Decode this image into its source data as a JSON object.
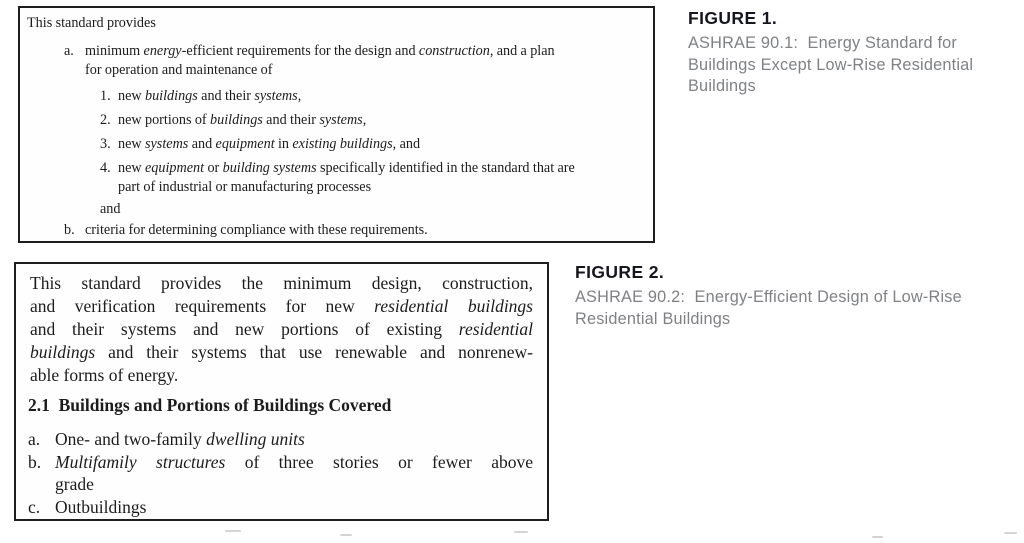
{
  "colors": {
    "page_background": "#ffffff",
    "box_border": "#1e1e1e",
    "scan_text": "#1c1c1c",
    "figure_label": "#16161f",
    "caption_text": "#7f8184"
  },
  "figure1": {
    "label": "FIGURE 1.",
    "caption": "ASHRAE 90.1:  Energy Standard for Buildings Except Low-Rise Residential Buildings"
  },
  "figure2": {
    "label": "FIGURE 2.",
    "caption": "ASHRAE 90.2:  Energy-Efficient Design of Low-Rise Residential Buildings"
  },
  "box1": {
    "intro": "This standard provides",
    "item_a": {
      "marker": "a.",
      "segments": [
        {
          "t": "minimum "
        },
        {
          "t": "energy",
          "i": true
        },
        {
          "t": "-efficient requirements for the design and "
        },
        {
          "t": "construction",
          "i": true
        },
        {
          "t": ", and a plan"
        },
        {
          "br": true
        },
        {
          "t": "for operation and maintenance of"
        }
      ]
    },
    "sub_items": [
      {
        "marker": "1.",
        "segments": [
          {
            "t": "new "
          },
          {
            "t": "buildings",
            "i": true
          },
          {
            "t": " and their "
          },
          {
            "t": "systems",
            "i": true
          },
          {
            "t": ","
          }
        ]
      },
      {
        "marker": "2.",
        "segments": [
          {
            "t": "new portions of "
          },
          {
            "t": "buildings",
            "i": true
          },
          {
            "t": " and their "
          },
          {
            "t": "systems",
            "i": true
          },
          {
            "t": ","
          }
        ]
      },
      {
        "marker": "3.",
        "segments": [
          {
            "t": "new "
          },
          {
            "t": "systems",
            "i": true
          },
          {
            "t": " and "
          },
          {
            "t": "equipment",
            "i": true
          },
          {
            "t": " in "
          },
          {
            "t": "existing buildings",
            "i": true
          },
          {
            "t": ", and"
          }
        ]
      },
      {
        "marker": "4.",
        "segments": [
          {
            "t": "new "
          },
          {
            "t": "equipment",
            "i": true
          },
          {
            "t": " or "
          },
          {
            "t": "building systems",
            "i": true
          },
          {
            "t": " specifically identified in the standard that are"
          },
          {
            "br": true
          },
          {
            "t": "part of industrial or manufacturing processes"
          }
        ]
      }
    ],
    "connector": "and",
    "item_b": {
      "marker": "b.",
      "segments": [
        {
          "t": "criteria for determining compliance with these requirements."
        }
      ]
    }
  },
  "box2": {
    "paragraph_lines": [
      [
        {
          "t": "This standard provides the minimum design, construction,"
        }
      ],
      [
        {
          "t": "and verification requirements for new "
        },
        {
          "t": "residential buildings",
          "i": true
        }
      ],
      [
        {
          "t": "and their systems and new portions of existing "
        },
        {
          "t": "residential",
          "i": true
        }
      ],
      [
        {
          "t": "buildings",
          "i": true
        },
        {
          "t": " and their systems that use renewable and nonrenew-"
        }
      ],
      [
        {
          "t": "able forms of energy."
        }
      ]
    ],
    "section_heading": "2.1  Buildings and Portions of Buildings Covered",
    "items": [
      {
        "marker": "a.",
        "lines": [
          [
            {
              "t": "One- and two-family "
            },
            {
              "t": "dwelling units",
              "i": true
            }
          ]
        ]
      },
      {
        "marker": "b.",
        "lines": [
          [
            {
              "t": "Multifamily structures",
              "i": true
            },
            {
              "t": " of three stories or fewer above"
            }
          ],
          [
            {
              "t": "grade"
            }
          ]
        ]
      },
      {
        "marker": "c.",
        "lines": [
          [
            {
              "t": "Outbuildings"
            }
          ]
        ]
      }
    ]
  }
}
